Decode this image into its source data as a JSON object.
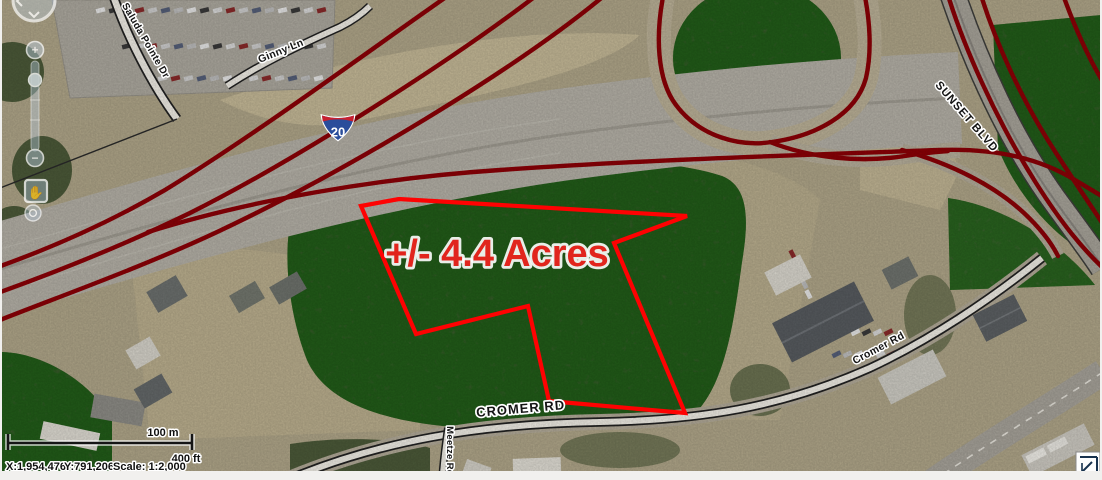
{
  "map": {
    "parcel": {
      "area_label": "+/- 4.4 Acres",
      "outline_color": "#fe0202"
    },
    "labels": {
      "saluda": "Saluda Pointe Dr",
      "ginny": "Ginny Ln",
      "sunset": "SUNSET BLVD",
      "cromer_main": "CROMER RD",
      "cromer_small": "Cromer Rd",
      "meetze": "Meetze Rd"
    },
    "interstate": {
      "number": "20"
    },
    "colors": {
      "highway_overlay": "#8d0006",
      "parcel_outline": "#fe0202",
      "area_text": "#e1251d",
      "label_text": "#141414",
      "label_halo": "#ffffff"
    }
  },
  "scale_bar": {
    "metric_label": "100 m",
    "imperial_label": "400 ft"
  },
  "status_bar": {
    "x_coord": "X:1,954,476",
    "y_coord": "Y:791,206",
    "scale": "Scale: 1:2,000"
  },
  "navigation": {
    "zoom_in": "+",
    "zoom_out": "−"
  }
}
